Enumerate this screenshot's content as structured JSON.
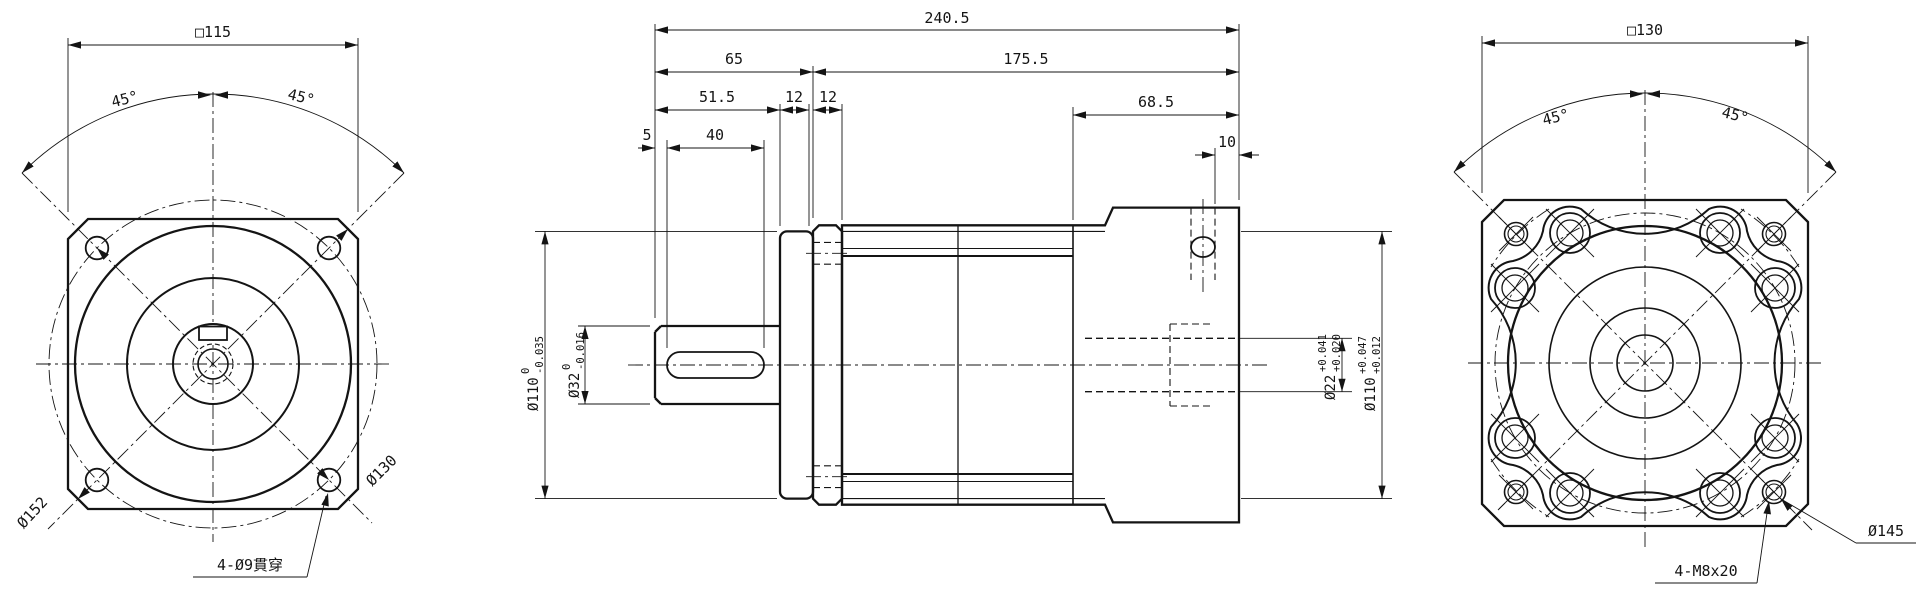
{
  "drawing": {
    "background": "#ffffff",
    "ink_color": "#141414",
    "front_view": {
      "square_width": "□115",
      "angle_left": "45°",
      "angle_right": "45°",
      "corner_diameter": "Ø152",
      "bolt_circle": "Ø130",
      "holes_note": "4-Ø9貫穿"
    },
    "side_view": {
      "total_length": "240.5",
      "front_length": "65",
      "body_length": "175.5",
      "shaft_length": "51.5",
      "ring_thickness": "12",
      "plate_thickness": "12",
      "key_offset": "5",
      "key_length": "40",
      "adapter_length": "68.5",
      "rear_offset": "10",
      "pilot_dia": {
        "value": "Ø110",
        "upper": "0",
        "lower": "-0.035"
      },
      "shaft_dia": {
        "value": "Ø32",
        "upper": "0",
        "lower": "-0.016"
      },
      "motor_shaft_bore": {
        "value": "Ø22",
        "upper": "+0.041",
        "lower": "+0.020"
      },
      "motor_pilot_bore": {
        "value": "Ø110",
        "upper": "+0.047",
        "lower": "+0.012"
      }
    },
    "rear_view": {
      "square_width": "□130",
      "angle_left": "45°",
      "angle_right": "45°",
      "bolt_circle": "Ø145",
      "holes_note": "4-M8x20"
    }
  }
}
